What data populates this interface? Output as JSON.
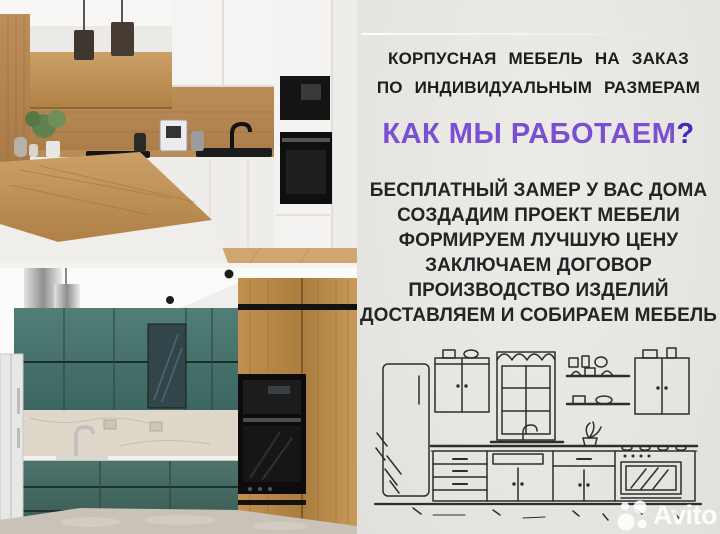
{
  "ad": {
    "header_line1": "КОРПУСНАЯ МЕБЕЛЬ НА ЗАКАЗ",
    "header_line2": "ПО ИНДИВИДУАЛЬНЫМ РАЗМЕРАМ",
    "title": "КАК МЫ РАБОТАЕМ",
    "title_question_mark": "?",
    "services": [
      "БЕСПЛАТНЫЙ ЗАМЕР У ВАС ДОМА",
      "СОЗДАДИМ ПРОЕКТ МЕБЕЛИ",
      "ФОРМИРУЕМ ЛУЧШУЮ ЦЕНУ",
      "ЗАКЛЮЧАЕМ ДОГОВОР",
      "ПРОИЗВОДСТВО ИЗДЕЛИЙ",
      "ДОСТАВЛЯЕМ И СОБИРАЕМ МЕБЕЛЬ"
    ]
  },
  "photos": {
    "top": {
      "name": "white-and-wood-kitchen-photo"
    },
    "bottom": {
      "name": "teal-and-wood-kitchen-photo"
    }
  },
  "sketch": {
    "name": "hand-drawn-kitchen-sketch"
  },
  "watermark": {
    "label": "Avito"
  },
  "colors": {
    "title_purple": "#7a4fd2",
    "question_mark_purple": "#3e2cc0",
    "panel_background": "#e8e6e2",
    "text_dark": "#1d1d1d",
    "sketch_stroke": "#2d2d2d",
    "teal_cabinet": "#47716a",
    "wood": "#b88955"
  }
}
